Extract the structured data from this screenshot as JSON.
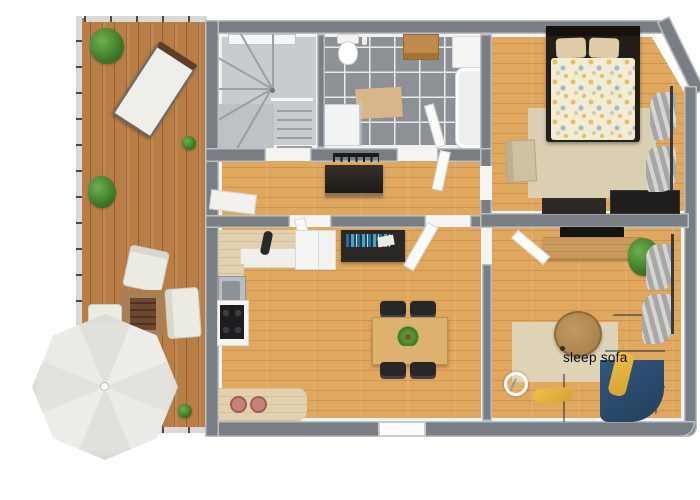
{
  "floorplan": {
    "labels": {
      "sleep_sofa": "sleep sofa"
    },
    "palette": {
      "background": "#ffffff",
      "wall_gray": "#797e84",
      "deck_wood": "#b97e45",
      "oak_floor": "#e0a75f",
      "bath_tile_gray": "#8d9196",
      "stair_gray": "#c9ccce",
      "sofa_blue": "#2c4e71",
      "pillow_yellow": "#e5b640",
      "rug_beige": "#d9cfb4",
      "kitchen_counter_pale": "#e2d0af",
      "parasol_gray": "#e8e6e2",
      "plant_green": "#3e7a2b",
      "bed_frame_dark": "#241e18",
      "duvet_cream": "#f2ebd6"
    }
  }
}
